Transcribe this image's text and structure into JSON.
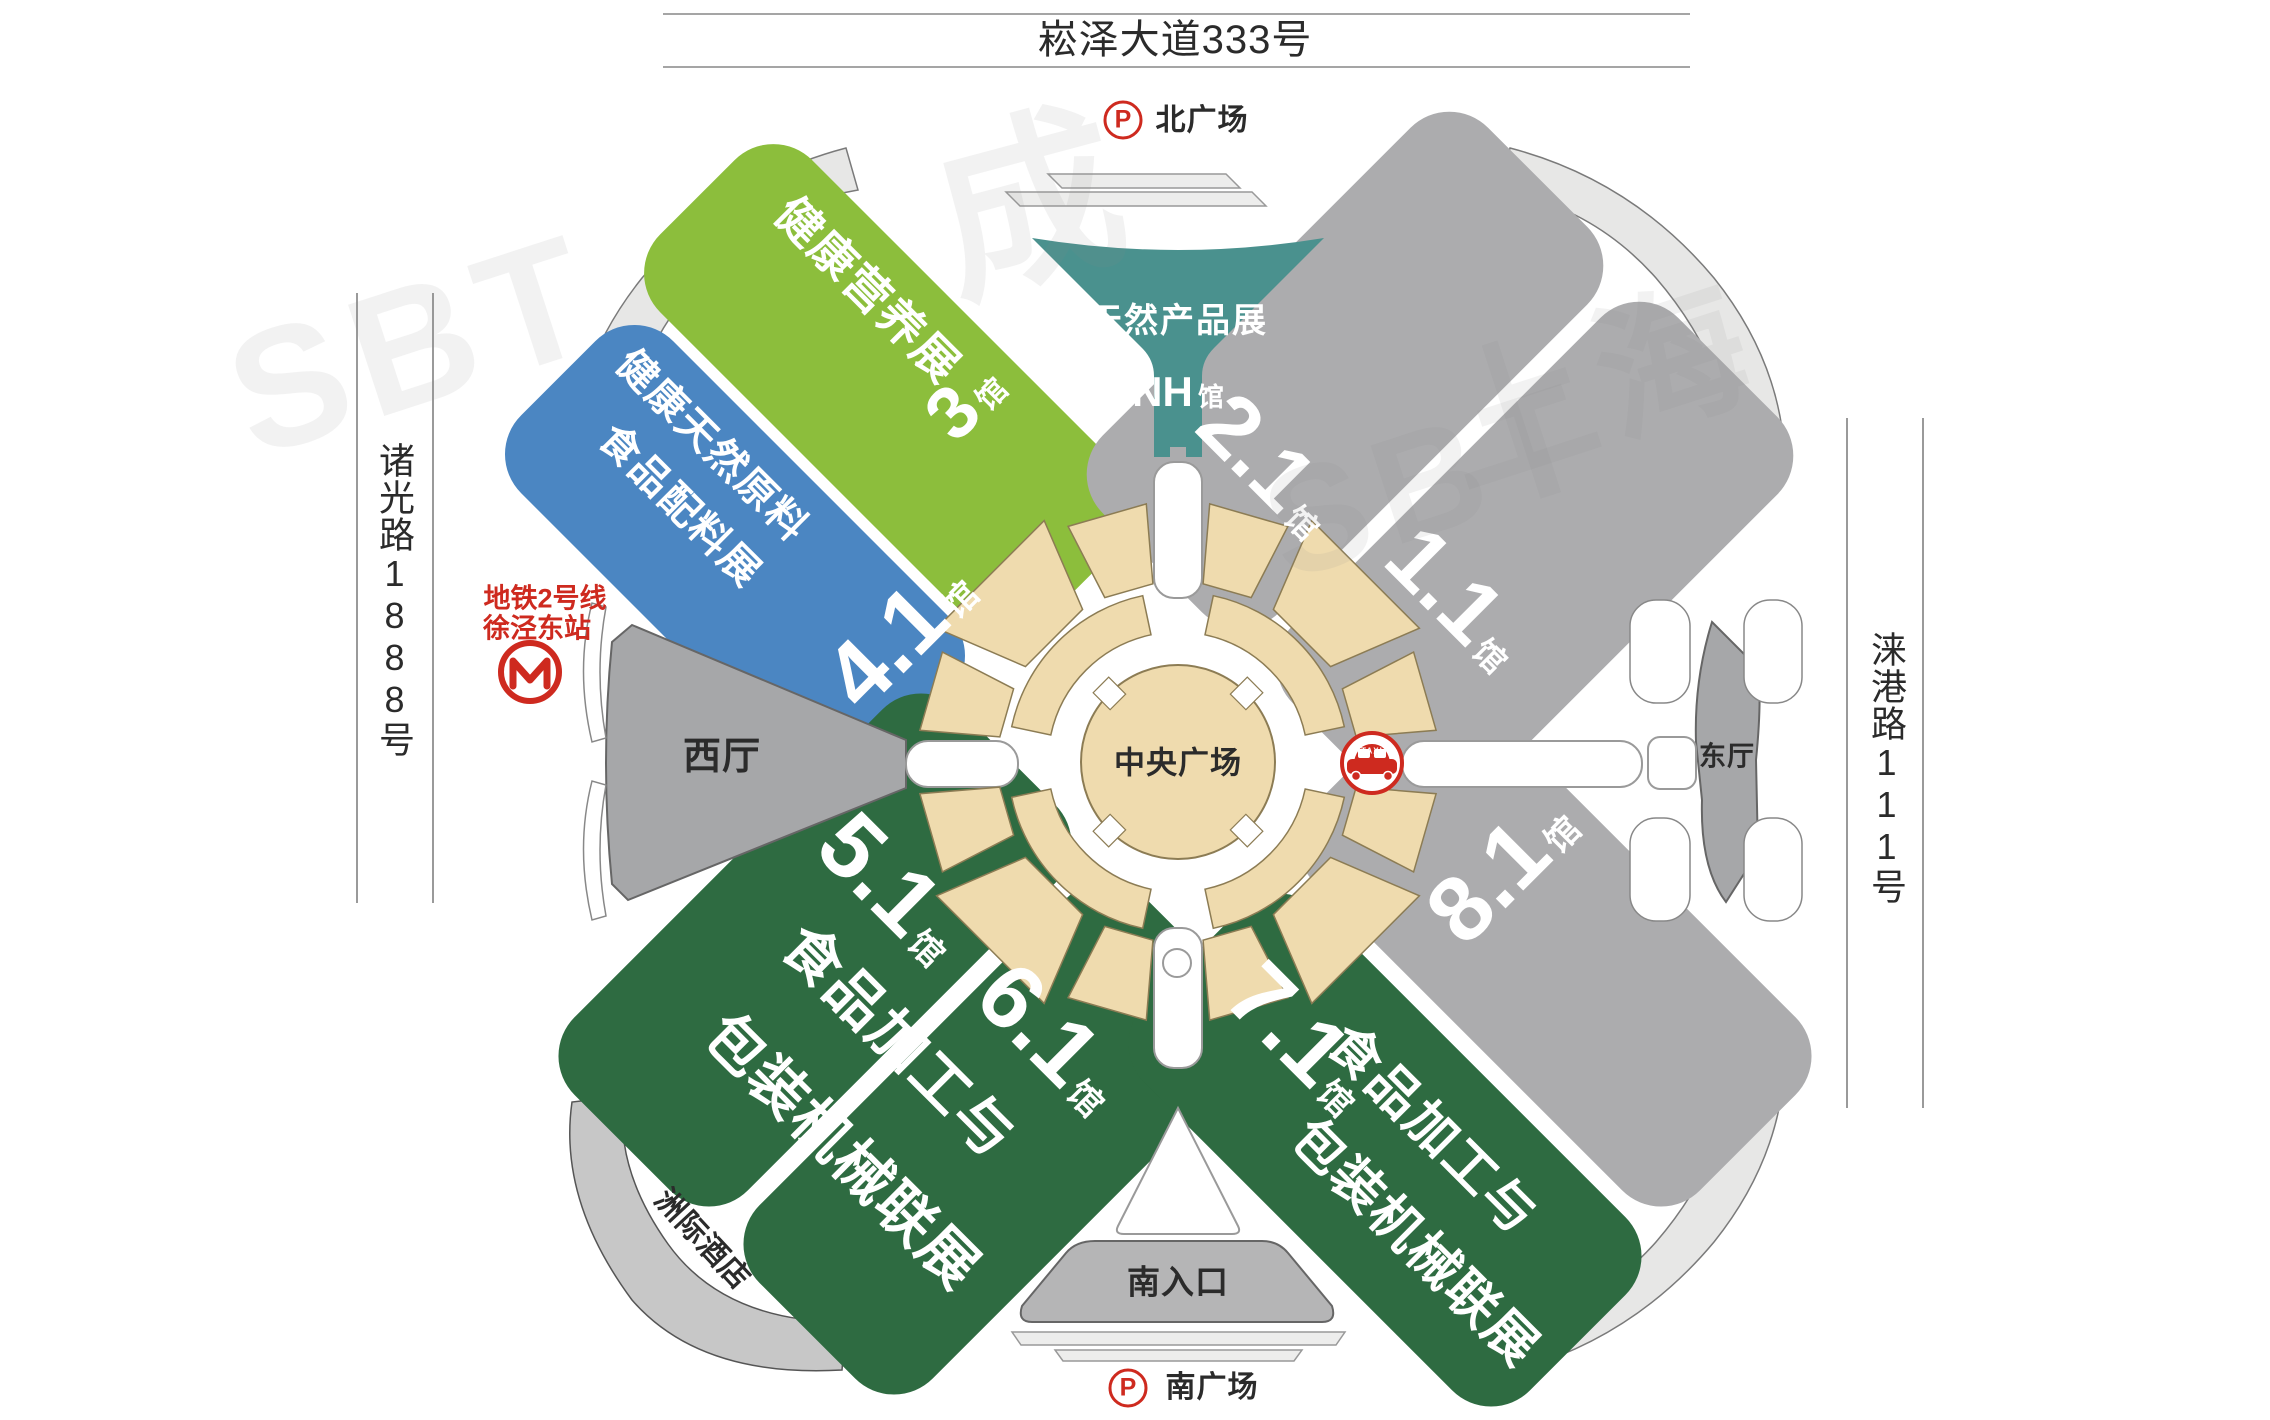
{
  "title": {
    "north_street": "崧泽大道333号"
  },
  "roads": {
    "west": "诸光路1888号",
    "east": "涞港路111号"
  },
  "plazas": {
    "north": "北广场",
    "south": "南广场",
    "central": "中央广场",
    "south_entrance": "南入口",
    "parking_symbol": "P"
  },
  "metro": {
    "line": "地铁2号线",
    "station": "徐泾东站"
  },
  "hotel": {
    "name": "洲际酒店"
  },
  "venue": {
    "west_hall": "西厅",
    "east_hall": "东厅"
  },
  "halls": {
    "h3": {
      "name": "健康营养展",
      "number": "3",
      "unit": "馆"
    },
    "h41": {
      "name_line1": "健康天然原料",
      "name_line2": "食品配料展",
      "number": "4.1",
      "unit": "馆"
    },
    "nh": {
      "name": "天然产品展",
      "number": "NH",
      "unit": "馆"
    },
    "h21": {
      "number": "2.1",
      "unit": "馆"
    },
    "h11": {
      "number": "1.1",
      "unit": "馆"
    },
    "h51": {
      "number": "5.1",
      "unit": "馆"
    },
    "h61": {
      "number": "6.1",
      "unit": "馆"
    },
    "h71": {
      "number": "7.1",
      "unit": "馆"
    },
    "h81": {
      "number": "8.1",
      "unit": "馆"
    },
    "sw_cluster": {
      "line1": "食品加工与",
      "line2": "包装机械联展"
    },
    "se_cluster": {
      "line1": "食品加工与",
      "line2": "包装机械联展"
    }
  },
  "icons": {
    "taxi_label": "TAXI"
  },
  "watermarks": {
    "wm1": "SBT",
    "wm2": "成",
    "wm3": "SBT",
    "wm4": "上海"
  },
  "colors": {
    "hall_green": "#8CBE3C",
    "hall_blue": "#4B86C2",
    "hall_teal": "#4A918E",
    "hall_gray": "#ACACAE",
    "hall_dark_green": "#2E6B41",
    "west_east_gray": "#A6A7A9",
    "plaza_tan": "#EFDBAE",
    "leaf_gray": "#E7E7E6",
    "hotel_gray": "#C7C7C7",
    "entrance_gray": "#B5B5B6",
    "bar_gray": "#EDEDEC",
    "accent_red": "#CE2A1F",
    "text_dark": "#2B2B2B"
  }
}
